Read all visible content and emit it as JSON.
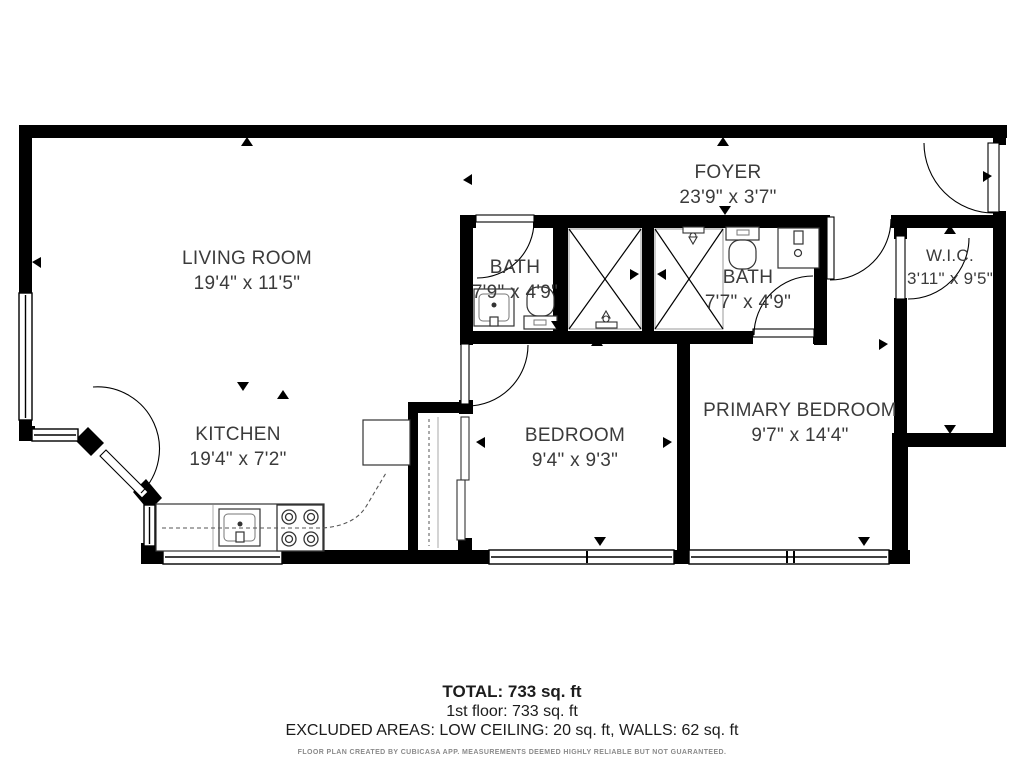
{
  "rooms": [
    {
      "name": "LIVING ROOM",
      "dims": "19'4\" x 11'5\""
    },
    {
      "name": "FOYER",
      "dims": "23'9\" x 3'7\""
    },
    {
      "name": "BATH",
      "dims": "7'9\" x 4'9\""
    },
    {
      "name": "BATH",
      "dims": "7'7\" x 4'9\""
    },
    {
      "name": "W.I.C.",
      "dims": "3'11\" x 9'5\""
    },
    {
      "name": "KITCHEN",
      "dims": "19'4\" x 7'2\""
    },
    {
      "name": "BEDROOM",
      "dims": "9'4\" x 9'3\""
    },
    {
      "name": "PRIMARY BEDROOM",
      "dims": "9'7\" x 14'4\""
    }
  ],
  "summary": {
    "total": "TOTAL: 733 sq. ft",
    "floor": "1st floor: 733 sq. ft",
    "excluded": "EXCLUDED AREAS: LOW CEILING: 20 sq. ft, WALLS: 62 sq. ft",
    "disclaimer": "FLOOR PLAN CREATED BY CUBICASA APP. MEASUREMENTS DEEMED HIGHLY RELIABLE BUT NOT GUARANTEED."
  },
  "colors": {
    "wall": "#000000",
    "room_label": "#3b3b3b",
    "fine_print": "#8a8a8a",
    "fixture_line": "#333333",
    "shower_outline": "#9a9a9a"
  }
}
